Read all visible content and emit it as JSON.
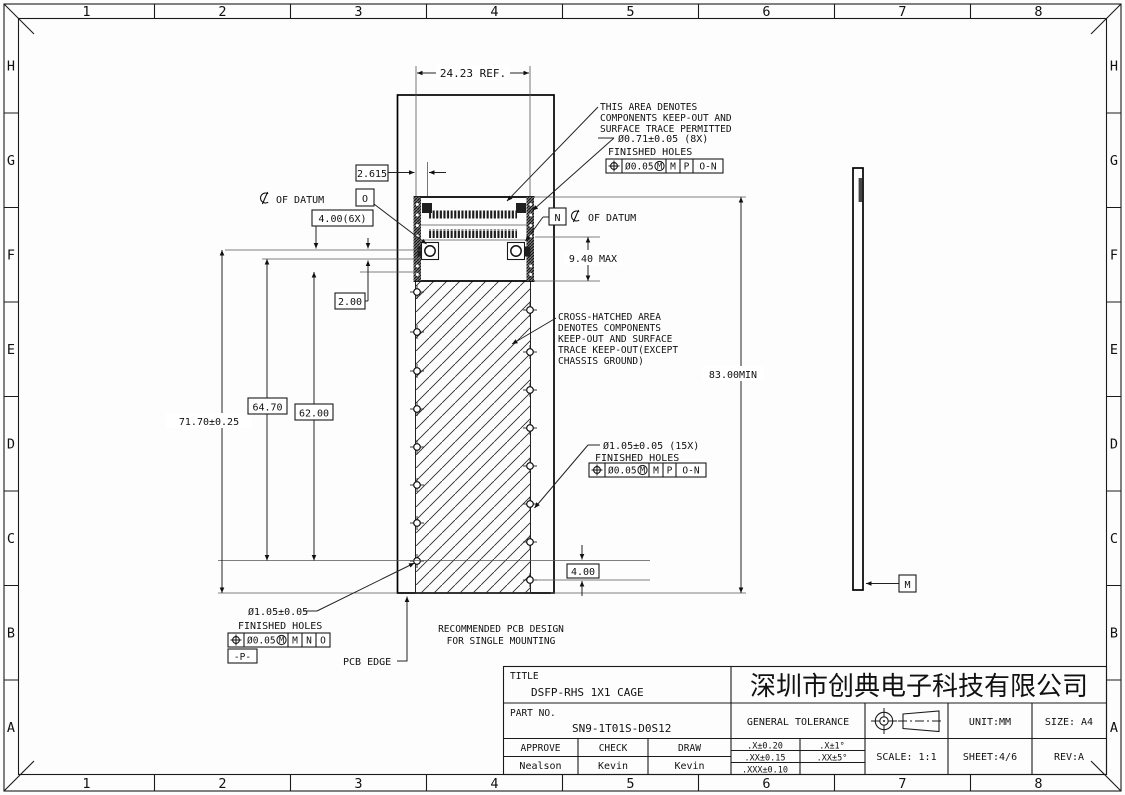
{
  "drawing": {
    "grid": {
      "cols": [
        "1",
        "2",
        "3",
        "4",
        "5",
        "6",
        "7",
        "8"
      ],
      "rows": [
        "H",
        "G",
        "F",
        "E",
        "D",
        "C",
        "B",
        "A"
      ]
    },
    "dims": {
      "ref_width": "24.23 REF.",
      "d2615": "2.615",
      "d400_6x": "4.00(6X)",
      "d200": "2.00",
      "d6470": "64.70",
      "d6200": "62.00",
      "d7170": "71.70±0.25",
      "d940": "9.40 MAX",
      "d8300": "83.00MIN",
      "d400": "4.00"
    },
    "callouts": {
      "keepout_note": [
        "THIS AREA DENOTES",
        "COMPONENTS KEEP-OUT AND",
        "SURFACE TRACE PERMITTED"
      ],
      "holes8": {
        "dia": "Ø0.71±0.05 (8X)",
        "label": "FINISHED HOLES",
        "tol": "Ø0.05",
        "mod": "M",
        "datums": [
          "M",
          "P",
          "O-N"
        ]
      },
      "crosshatch_note": [
        "CROSS-HATCHED AREA",
        "DENOTES COMPONENTS",
        "KEEP-OUT AND SURFACE",
        "TRACE KEEP-OUT(EXCEPT",
        "CHASSIS GROUND)"
      ],
      "holes15": {
        "dia": "Ø1.05±0.05 (15X)",
        "label": "FINISHED HOLES",
        "tol": "Ø0.05",
        "mod": "M",
        "datums": [
          "M",
          "P",
          "O-N"
        ]
      },
      "holeP": {
        "dia": "Ø1.05±0.05",
        "label": "FINISHED HOLES",
        "tol": "Ø0.05",
        "mod": "M",
        "datums": [
          "M",
          "N",
          "O"
        ],
        "datum_flag": "-P-"
      },
      "datum_o": {
        "datum": "O",
        "text": "OF DATUM"
      },
      "datum_n": {
        "datum": "N",
        "text": "OF DATUM"
      },
      "datum_m": "M",
      "pcb_edge": "PCB EDGE",
      "recommend": [
        "RECOMMENDED PCB DESIGN",
        "FOR SINGLE MOUNTING"
      ]
    }
  },
  "title_block": {
    "title_label": "TITLE",
    "title": "DSFP-RHS 1X1 CAGE",
    "part_label": "PART NO.",
    "part_no": "SN9-1T01S-D0S12",
    "approve_label": "APPROVE",
    "check_label": "CHECK",
    "draw_label": "DRAW",
    "approve": "Nealson",
    "check": "Kevin",
    "draw": "Kevin",
    "company": "深圳市创典电子科技有限公司",
    "tol_label": "GENERAL TOLERANCE",
    "tols": [
      ".X±0.20",
      ".XX±0.15",
      ".XXX±0.10"
    ],
    "ang_tols": [
      ".X±1°",
      ".XX±5°"
    ],
    "scale": "SCALE: 1:1",
    "unit": "UNIT:MM",
    "sheet": "SHEET:4/6",
    "size": "SIZE: A4",
    "rev": "REV:A"
  }
}
